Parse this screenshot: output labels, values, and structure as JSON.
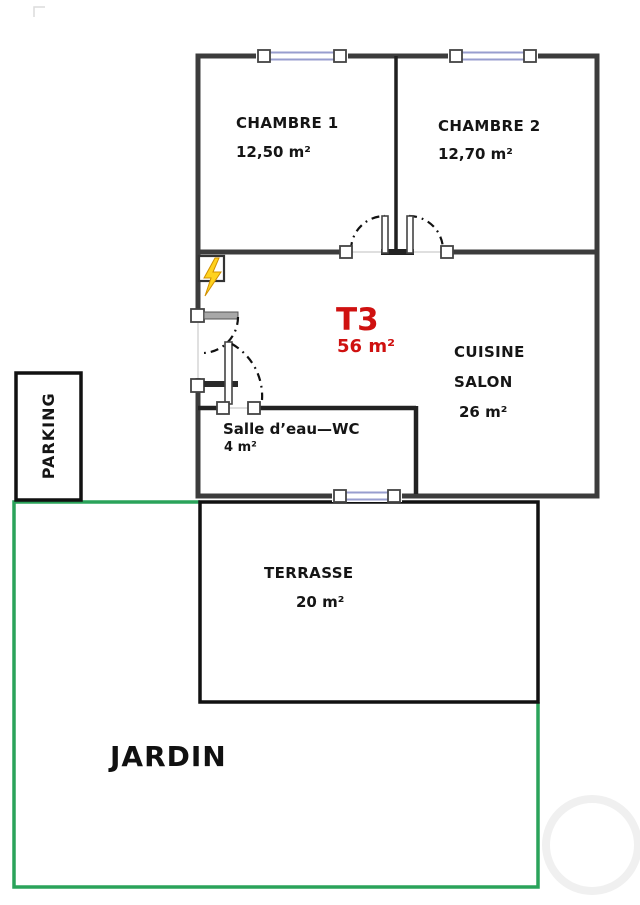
{
  "plan": {
    "unit": {
      "type": "T3",
      "area": "56 m²"
    },
    "rooms": {
      "chambre1": {
        "name": "CHAMBRE 1",
        "area": "12,50 m²"
      },
      "chambre2": {
        "name": "CHAMBRE 2",
        "area": "12,70 m²"
      },
      "cuisine_salon": {
        "line1": "CUISINE",
        "line2": "SALON",
        "area": "26 m²"
      },
      "salle_eau_wc": {
        "name": "Salle d’eau—WC",
        "area": "4 m²"
      },
      "terrasse": {
        "name": "TERRASSE",
        "area": "20 m²"
      },
      "parking": {
        "name": "PARKING"
      },
      "jardin": {
        "name": "JARDIN"
      }
    },
    "icons": {
      "electrical_panel": "lightning-bolt"
    },
    "colors": {
      "wall": "#3c3c3c",
      "inner_wall": "#1f1f1f",
      "accent_red": "#cf1110",
      "garden_green": "#2aa35a",
      "window_blue": "#989ecf",
      "bolt_yellow": "#ffd21e"
    }
  }
}
